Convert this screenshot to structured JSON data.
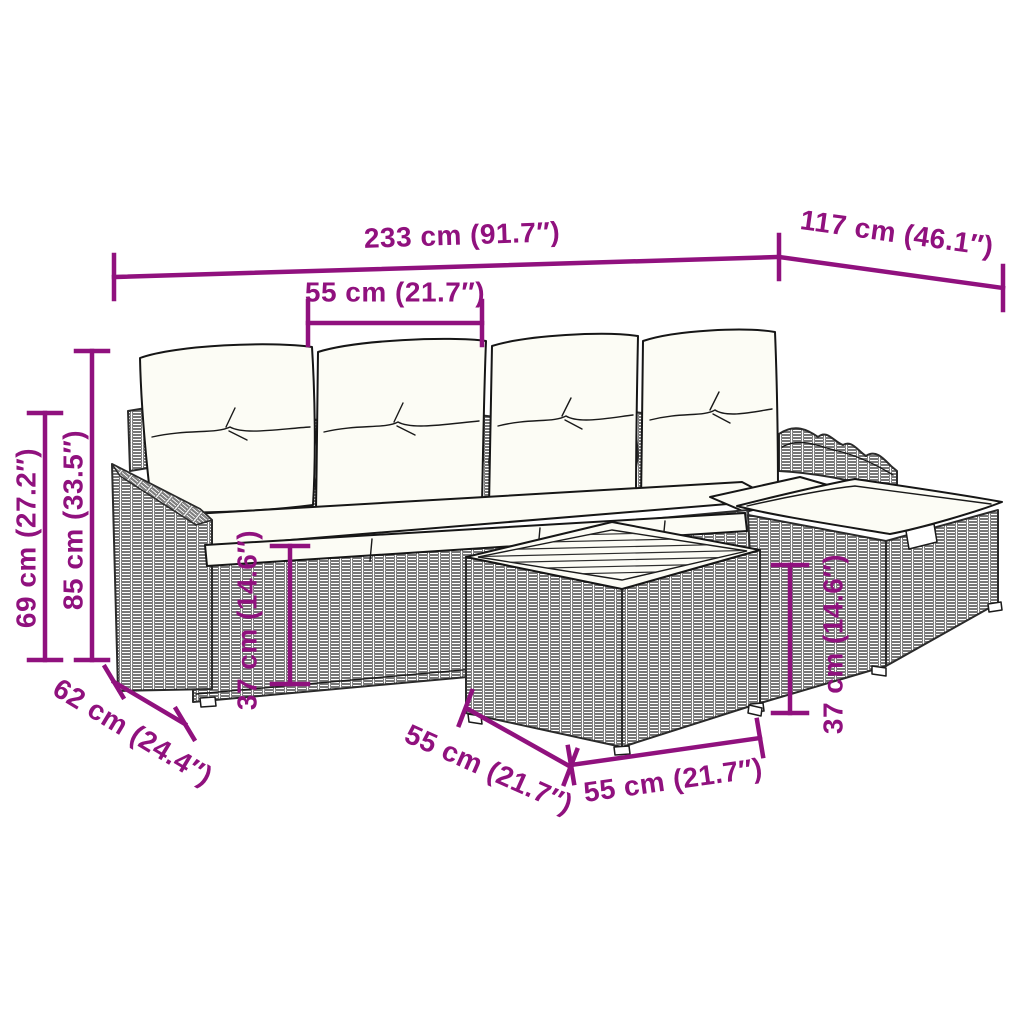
{
  "figure": {
    "type": "product-dimension-diagram",
    "subject": "rattan-garden-lounge-set-with-footstool-and-table",
    "background_color": "#ffffff",
    "accent_color": "#90117E",
    "outline_color": "#1a1a1a"
  },
  "annotations": [
    {
      "id": "overall-width",
      "label": "233 cm (91.7″)",
      "cm": 233,
      "inches": 91.7
    },
    {
      "id": "overall-depth",
      "label": "117 cm (46.1″)",
      "cm": 117,
      "inches": 46.1
    },
    {
      "id": "seat-width",
      "label": "55 cm (21.7″)",
      "cm": 55,
      "inches": 21.7
    },
    {
      "id": "armrest-height",
      "label": "69 cm (27.2″)",
      "cm": 69,
      "inches": 27.2
    },
    {
      "id": "backrest-height",
      "label": "85 cm (33.5″)",
      "cm": 85,
      "inches": 33.5
    },
    {
      "id": "seat-height",
      "label": "37 cm (14.6″)",
      "cm": 37,
      "inches": 14.6
    },
    {
      "id": "seat-depth",
      "label": "62 cm (24.4″)",
      "cm": 62,
      "inches": 24.4
    },
    {
      "id": "table-depth",
      "label": "55 cm (21.7″)",
      "cm": 55,
      "inches": 21.7
    },
    {
      "id": "table-width",
      "label": "55 cm (21.7″)",
      "cm": 55,
      "inches": 21.7
    },
    {
      "id": "footstool-height",
      "label": "37 cm (14.6″)",
      "cm": 37,
      "inches": 14.6
    }
  ]
}
